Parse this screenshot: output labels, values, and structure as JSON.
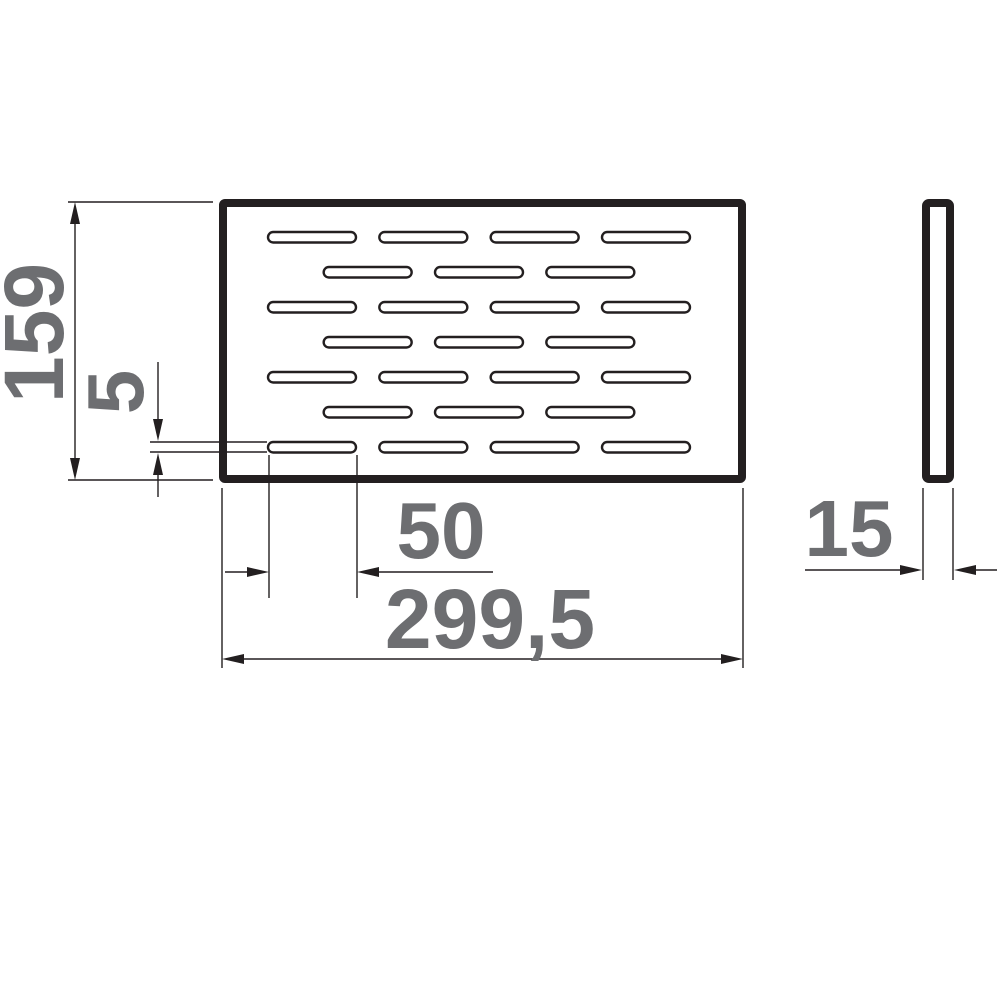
{
  "colors": {
    "line": "#231f20",
    "dimension_text": "#6d6e71",
    "background": "#ffffff"
  },
  "dims": {
    "height": "159",
    "slot_height": "5",
    "slot_width": "50",
    "total_width": "299,5",
    "depth": "15"
  },
  "front_view": {
    "slot_rows": 7,
    "slots_per_odd_row": 4,
    "slots_per_even_row": 3
  }
}
